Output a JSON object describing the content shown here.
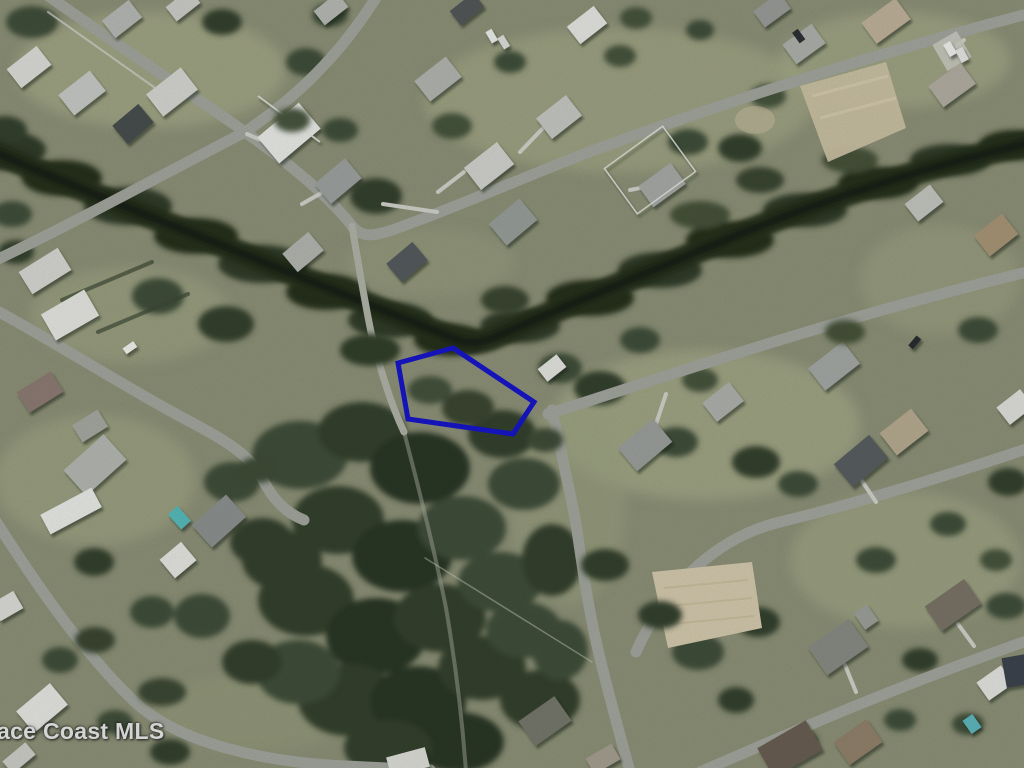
{
  "watermark": {
    "text": "ace Coast MLS"
  },
  "parcel": {
    "polygon_points": "453,348 398,363 408,419 513,434 534,402",
    "outline_color": "#1616cb",
    "outline_width": "5"
  },
  "palette": {
    "grass_base": "#8f9379",
    "lawn_light": "#a9ae8c",
    "tree_dark": "#2c3827",
    "canal_dark": "#27331f",
    "road_gray": "#a4a89f",
    "dirt_tan": "#cfc4a6",
    "pool_teal": "#59bdbd",
    "roof_white": "#eceeea",
    "roof_dark": "#4a4f50"
  }
}
